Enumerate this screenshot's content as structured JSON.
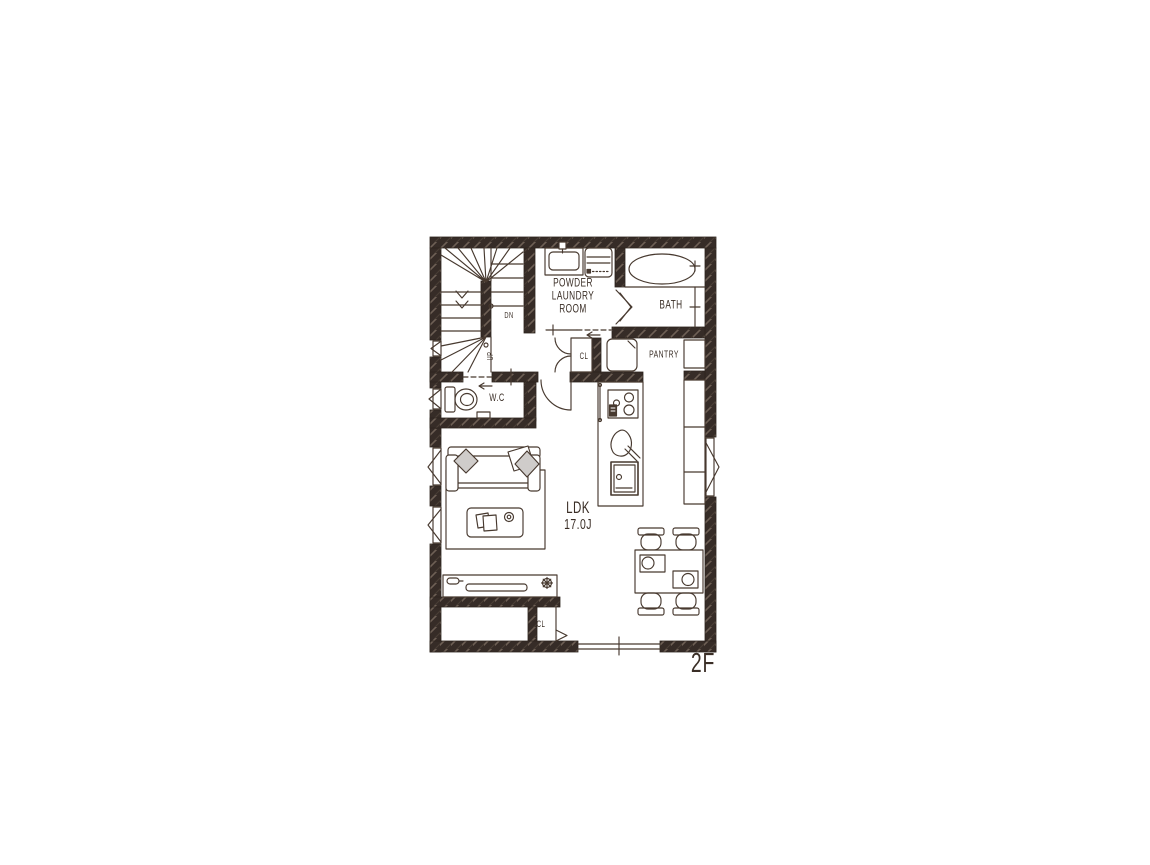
{
  "plan": {
    "floor_label": "2F",
    "labels": {
      "powder_line1": "POWDER",
      "powder_line2": "LAUNDRY",
      "powder_line3": "ROOM",
      "bath": "BATH",
      "pantry": "PANTRY",
      "closet_upper": "CL",
      "wc": "W.C",
      "stairs_down": "DN",
      "stairs_up": "UP",
      "ldk_name": "LDK",
      "ldk_size": "17.0J",
      "closet_lower": "CL"
    },
    "colors": {
      "wall": "#362c27",
      "wall_hatch_light": "#6e6055",
      "line": "#47392f",
      "cushion": "#cfccca",
      "background": "#ffffff"
    }
  }
}
